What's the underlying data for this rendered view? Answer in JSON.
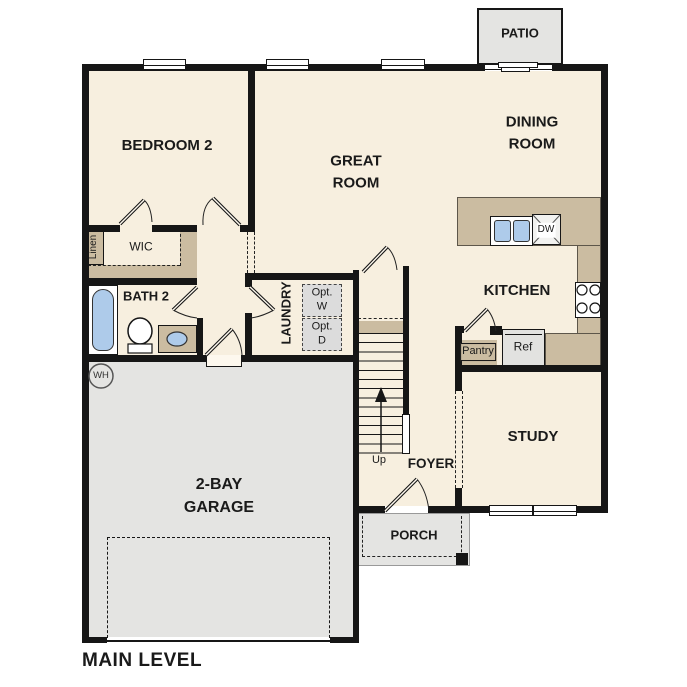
{
  "plan": {
    "title": "MAIN LEVEL",
    "rooms": {
      "bedroom2": "BEDROOM 2",
      "great_room": "GREAT ROOM",
      "dining_room": "DINING ROOM",
      "kitchen": "KITCHEN",
      "study": "STUDY",
      "foyer": "FOYER",
      "garage": "2-BAY GARAGE",
      "bath2": "BATH 2",
      "laundry": "LAUNDRY",
      "wic": "WIC",
      "linen": "Linen",
      "patio": "PATIO",
      "porch": "PORCH"
    },
    "fixtures": {
      "opt_washer": "Opt. W",
      "opt_dryer": "Opt. D",
      "up": "Up",
      "pantry": "Pantry",
      "ref": "Ref",
      "dishwasher": "DW",
      "water_heater": "WH"
    },
    "colors": {
      "wall": "#161616",
      "floor": "#f7efdf",
      "counter": "#cbbca1",
      "garage_floor": "#e4e4e2",
      "fixture_blue": "#aecbea",
      "optional_gray": "#dcdcdc"
    }
  }
}
